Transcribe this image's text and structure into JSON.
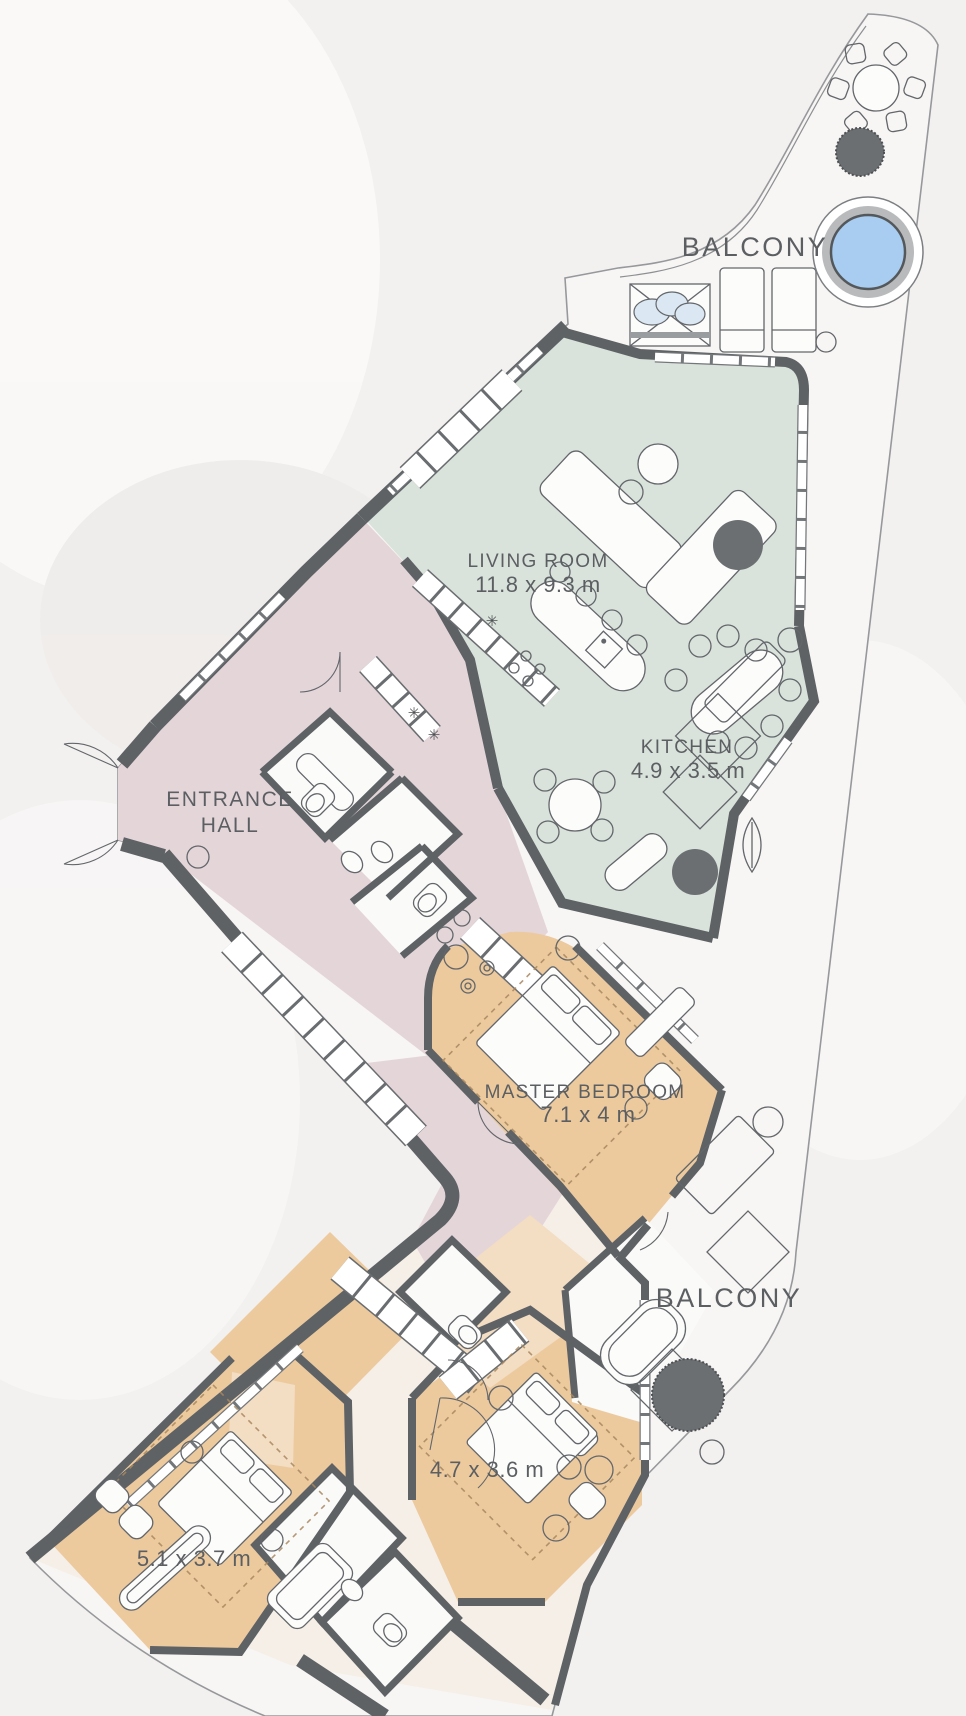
{
  "plan": {
    "labels": {
      "balcony_top": "BALCONY",
      "living_room_name": "LIVING ROOM",
      "living_room_size": "11.8 x 9.3 m",
      "kitchen_name": "KITCHEN",
      "kitchen_size": "4.9 x 3.5 m",
      "entrance_hall_line1": "ENTRANCE",
      "entrance_hall_line2": "HALL",
      "master_bedroom_name": "MASTER BEDROOM",
      "master_bedroom_size": "7.1 x 4 m",
      "balcony_bottom": "BALCONY",
      "bedroom_2_size": "4.7 x 3.6 m",
      "bedroom_3_size": "5.1 x 3.7 m",
      "appliance_symbol": "✳"
    },
    "colors": {
      "background": "#f3f1ef",
      "wall": "#5e6265",
      "living_kitchen": "#d9e2db",
      "hall_corridor": "#e4d5d9",
      "bedroom": "#ecca9e",
      "bedroom_light": "#f3ddc3",
      "wing_base": "#f5efe7",
      "balcony_floor": "#f7f6f4",
      "pool_water": "#a8cdf1",
      "pool_ring": "#b8babc",
      "planter": "#6b6f72",
      "label_text": "#5c5f62",
      "dashed_measure": "#a8875f"
    }
  }
}
